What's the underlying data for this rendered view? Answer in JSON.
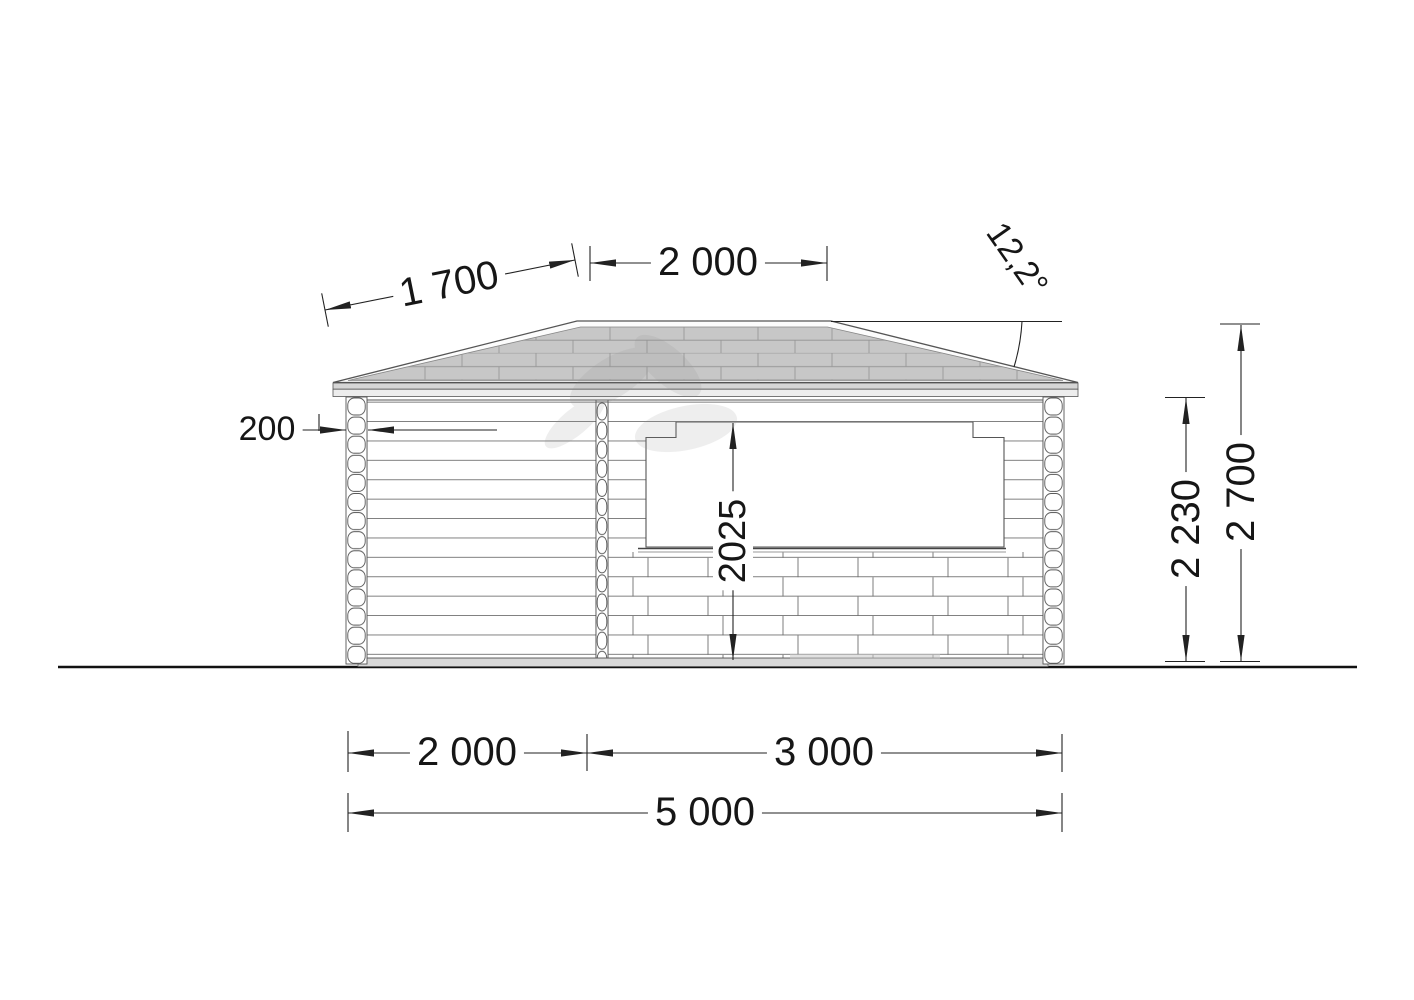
{
  "drawing": {
    "dim_roof_slope": "1 700",
    "dim_ridge": "2 000",
    "dim_roof_angle": "12,2°",
    "dim_post_width": "200",
    "dim_opening_height": "2025",
    "dim_wall_height": "2 230",
    "dim_total_height": "2 700",
    "dim_span_left": "2 000",
    "dim_span_right": "3 000",
    "dim_span_total": "5 000"
  },
  "colors": {
    "line": "#222222",
    "outline": "#555555",
    "roof_fill": "#c7c7c7",
    "fascia_upper": "#d6d6d6",
    "fascia_lower": "#ededed",
    "base_fill": "#d8d8d8",
    "background": "#ffffff"
  }
}
